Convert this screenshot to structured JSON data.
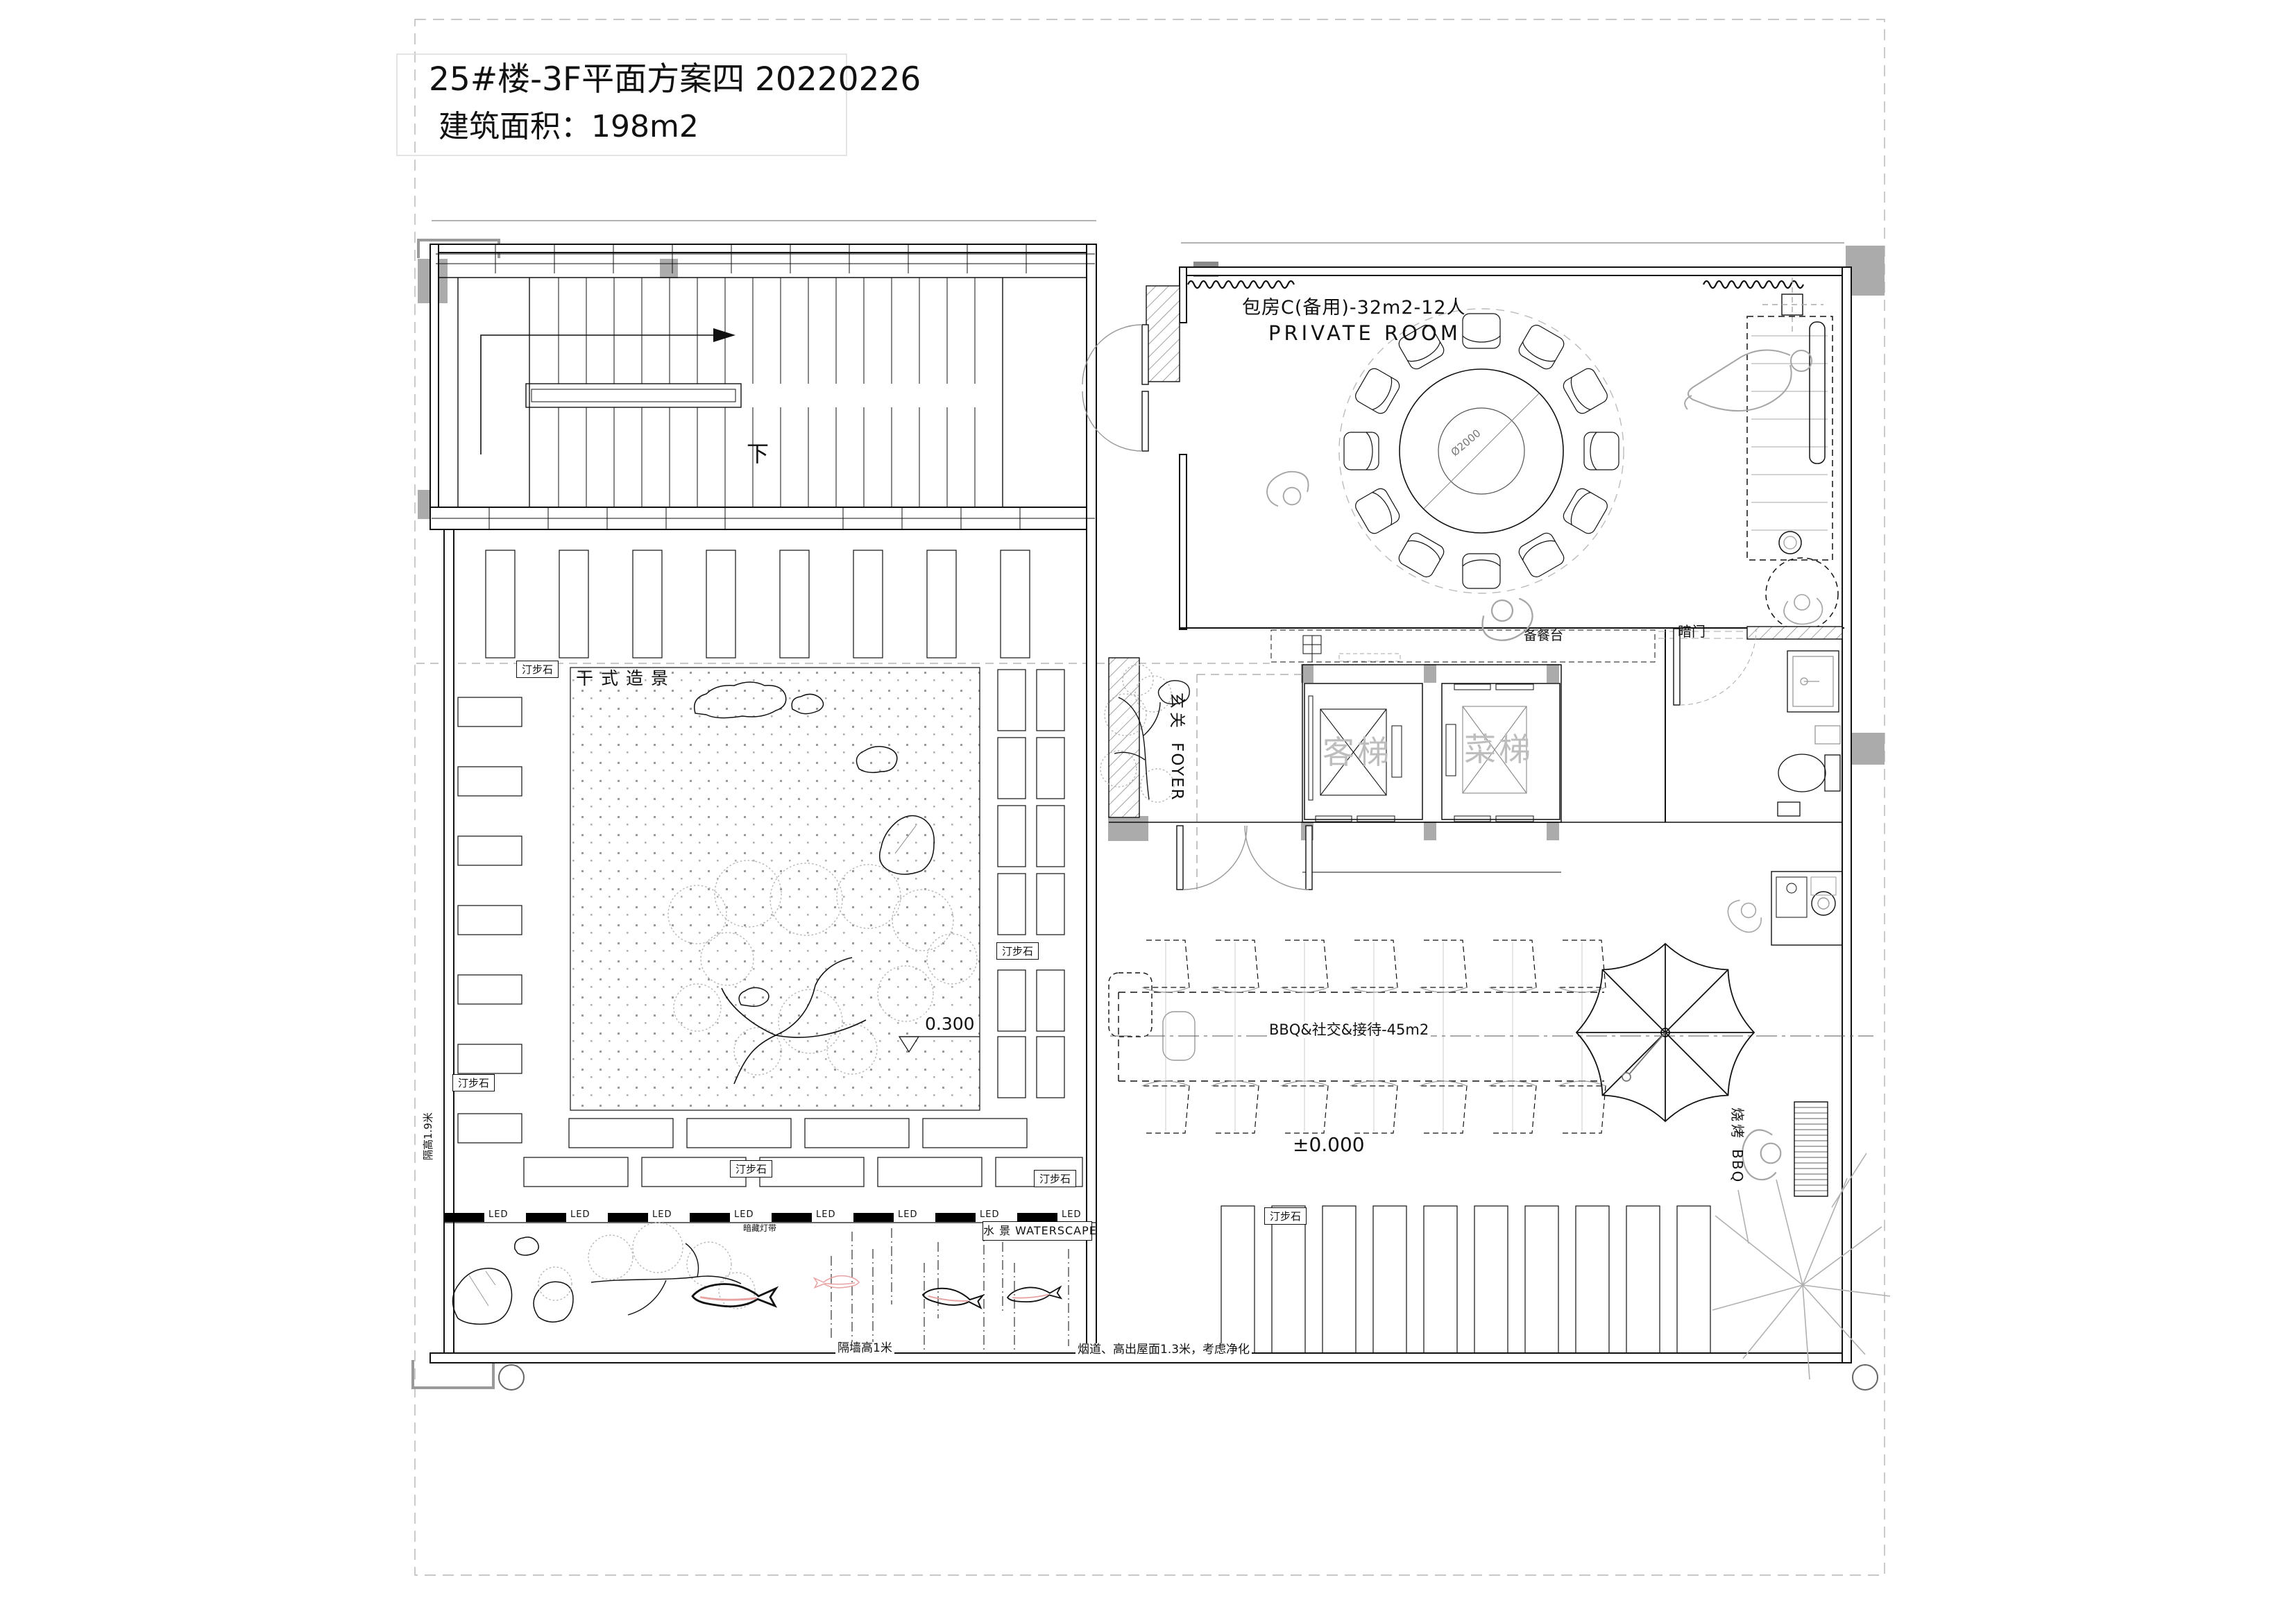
{
  "title": {
    "line1": "25#楼-3F平面方案四 20220226",
    "line2": "建筑面积：198m2"
  },
  "rooms": {
    "private_room": {
      "name_cn": "包房C(备用)-32m2-12人",
      "name_en": "PRIVATE ROOM",
      "table_diameter": "Ø2000"
    },
    "foyer": {
      "name_cn": "玄关",
      "name_en": "FOYER"
    },
    "elevator_passenger": "客梯",
    "elevator_service": "菜梯",
    "dry_garden": "干式造景",
    "waterscape": "水 景 WATERSCAPE",
    "bbq_zone": "BBQ&社交&接待-45m2",
    "grill_cn": "烧烤",
    "grill_en": "BBQ"
  },
  "annotations": {
    "prep_counter": "备餐台",
    "hidden_door": "暗门",
    "stair_down": "下",
    "stepping_stone": "汀步石",
    "elevation_garden": "0.300",
    "elevation_bbq": "±0.000",
    "led": "LED",
    "hidden_light": "暗藏灯带",
    "partition_note": "隔墙高1米",
    "partition_note_left": "隔高1.9米",
    "flue_note": "烟道、高出屋面1.3米，考虑净化"
  },
  "colors": {
    "line": "#111111",
    "gray_furniture": "#9c9c9c",
    "light_gray": "#c4c4c4",
    "column_fill": "#ababab",
    "elevator_text": "#bdbdbd",
    "fish_accent": "#e8a2a2"
  }
}
